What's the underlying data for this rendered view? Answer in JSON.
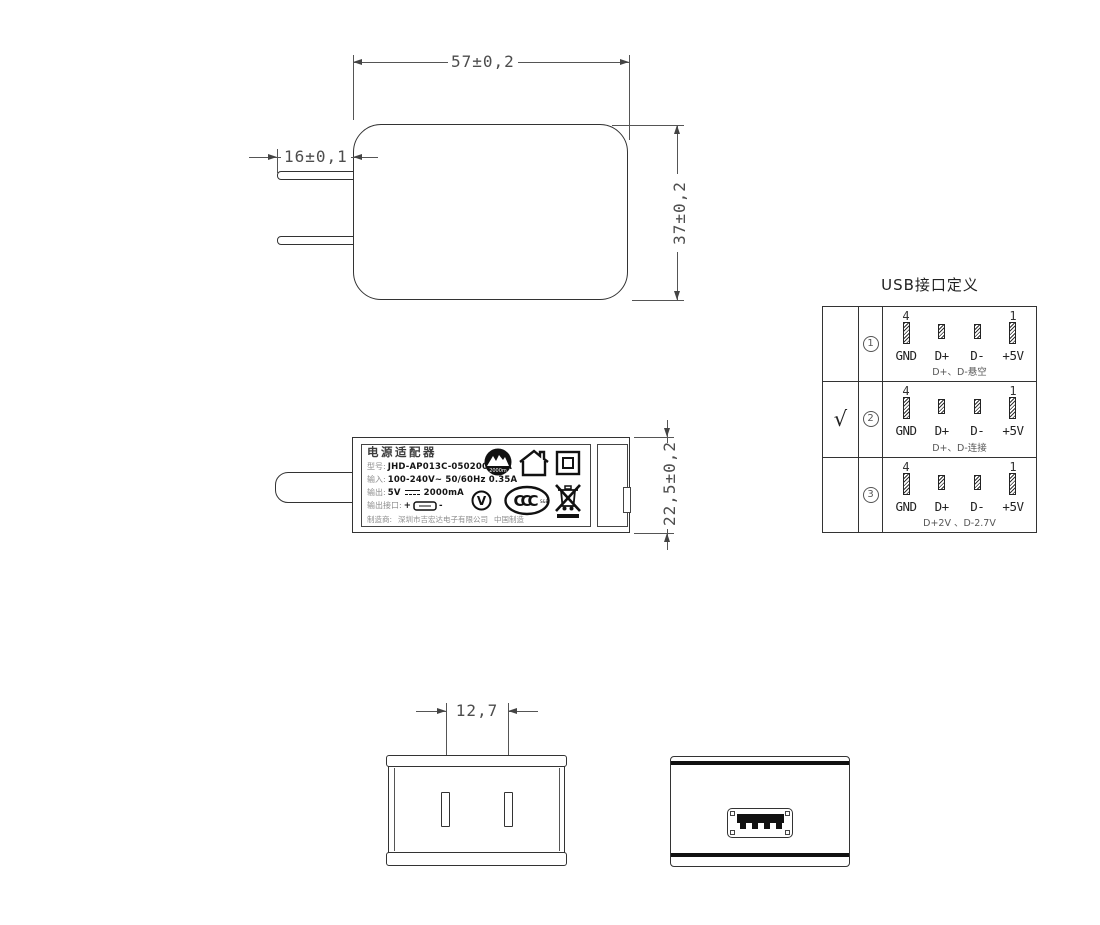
{
  "front_view": {
    "width_dim": "57±0,2",
    "height_dim": "37±0,2",
    "prong_dim": "16±0,1"
  },
  "side_view": {
    "height_dim": "22,5±0,2",
    "label": {
      "title": "电源适配器",
      "model_label": "型号:",
      "model_value": "JHD-AP013C-050200BB-A",
      "input_label": "输入:",
      "input_value": "100-240V~ 50/60Hz 0.35A",
      "output_label": "输出:",
      "output_value_v": "5V",
      "output_value_ma": "2000mA",
      "port_label": "输出接口:",
      "port_plus": "+",
      "port_minus": "-",
      "maker_label": "制造商:",
      "maker_value": "深圳市吉宏达电子有限公司",
      "made_in": "中国制造",
      "icons": {
        "altitude_text": "2000m",
        "efficiency": "V",
        "ccc": "CCC",
        "ccc_sub": "S&E"
      }
    }
  },
  "bottom_view": {
    "pin_spacing_dim": "12,7"
  },
  "usb_table": {
    "title": "USB接口定义",
    "rows": [
      {
        "check": "",
        "num": "1",
        "pin_first": "4",
        "pin_last": "1",
        "pin_labels": [
          "GND",
          "D+",
          "D-",
          "+5V"
        ],
        "note": "D+、D-悬空"
      },
      {
        "check": "√",
        "num": "2",
        "pin_first": "4",
        "pin_last": "1",
        "pin_labels": [
          "GND",
          "D+",
          "D-",
          "+5V"
        ],
        "note": "D+、D-连接"
      },
      {
        "check": "",
        "num": "3",
        "pin_first": "4",
        "pin_last": "1",
        "pin_labels": [
          "GND",
          "D+",
          "D-",
          "+5V"
        ],
        "note": "D+2V 、D-2.7V"
      }
    ]
  }
}
